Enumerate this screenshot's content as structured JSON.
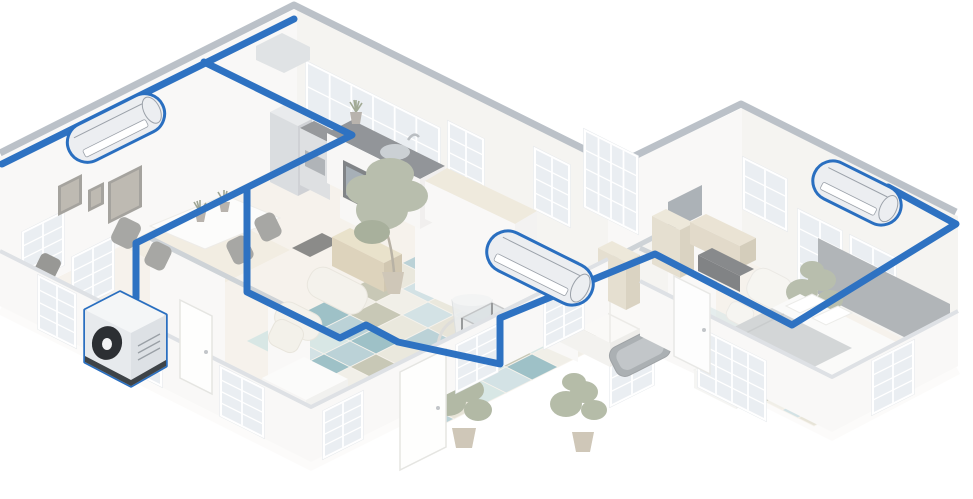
{
  "colors": {
    "background": "#ffffff",
    "pipe": "#2e72c2",
    "unitStroke": "#2a6fc0",
    "unitFill": "#eceef1",
    "unitDetail": "#9ba1a9",
    "wallTop": "#8e99a5",
    "partitionTop": "#aeb6be",
    "lowWallTop": "#c9ced4",
    "wallFace": "#f6f5f2",
    "wallFaceShade": "#efede9",
    "floor": "#f1ebe0",
    "floorFascia": "#fbfaf7",
    "diningInlay": "#e7dcc4",
    "windowFrame": "#ffffff",
    "windowPane": "#dde4eb",
    "frameOuter": "#6b675f",
    "frameInner": "#938d80",
    "outdoorDark": "#3e4347",
    "fanDark": "#2c2f33",
    "rugPalette": [
      "#8fb5be",
      "#b7cfd5",
      "#a4a487",
      "#d8d3bf",
      "#5f98a2",
      "#ddd9c7",
      "#bfd8d5",
      "#e9e6da"
    ]
  },
  "system": {
    "outdoor_unit": {
      "name": "outdoor-condenser-unit"
    },
    "indoor_units": [
      {
        "name": "indoor-wall-unit-left-room",
        "cx": 116,
        "cy": 128,
        "angle": -26.5,
        "length": 104,
        "height": 40
      },
      {
        "name": "indoor-wall-unit-center-room",
        "cx": 540,
        "cy": 268,
        "angle": 26.5,
        "length": 114,
        "height": 42
      },
      {
        "name": "indoor-wall-unit-right-bedroom",
        "cx": 857,
        "cy": 193,
        "angle": 26.5,
        "length": 94,
        "height": 40
      }
    ],
    "pipe_runs": [
      {
        "name": "pipe-back-wall-run",
        "points": [
          [
            2,
            164
          ],
          [
            294,
            19
          ]
        ]
      },
      {
        "name": "pipe-kitchen-branch",
        "points": [
          [
            204,
            62
          ],
          [
            352,
            135
          ],
          [
            136,
            243
          ],
          [
            136,
            298
          ]
        ]
      },
      {
        "name": "pipe-main-trunk",
        "points": [
          [
            247,
            190
          ],
          [
            247,
            292
          ],
          [
            340,
            338
          ],
          [
            366,
            325
          ],
          [
            398,
            342
          ],
          [
            500,
            364
          ],
          [
            500,
            318
          ],
          [
            655,
            254
          ],
          [
            792,
            325
          ],
          [
            956,
            224
          ],
          [
            888,
            187
          ]
        ]
      }
    ]
  },
  "windows": [
    {
      "x": 24,
      "y": 233,
      "w": 38,
      "h": 50,
      "skew": "v",
      "layer": "back",
      "cols": 2,
      "rows": 4
    },
    {
      "x": 74,
      "y": 258,
      "w": 38,
      "h": 50,
      "skew": "v",
      "layer": "back",
      "cols": 2,
      "rows": 4
    },
    {
      "x": 308,
      "y": 64,
      "w": 130,
      "h": 92,
      "skew": "u",
      "layer": "back",
      "cols": 6,
      "rows": 4
    },
    {
      "x": 450,
      "y": 124,
      "w": 32,
      "h": 58,
      "skew": "u",
      "layer": "back",
      "cols": 2,
      "rows": 4
    },
    {
      "x": 536,
      "y": 150,
      "w": 32,
      "h": 58,
      "skew": "u",
      "layer": "back",
      "cols": 2,
      "rows": 4
    },
    {
      "x": 586,
      "y": 132,
      "w": 50,
      "h": 74,
      "skew": "u",
      "layer": "back",
      "cols": 4,
      "rows": 4
    },
    {
      "x": 745,
      "y": 160,
      "w": 40,
      "h": 48,
      "skew": "u",
      "layer": "back",
      "cols": 2,
      "rows": 3
    },
    {
      "x": 800,
      "y": 212,
      "w": 40,
      "h": 68,
      "skew": "u",
      "layer": "back",
      "cols": 2,
      "rows": 4
    },
    {
      "x": 852,
      "y": 238,
      "w": 42,
      "h": 68,
      "skew": "u",
      "layer": "back",
      "cols": 2,
      "rows": 4
    },
    {
      "x": 612,
      "y": 352,
      "w": 40,
      "h": 52,
      "skew": "v",
      "layer": "back",
      "cols": 2,
      "rows": 4
    },
    {
      "x": 40,
      "y": 278,
      "w": 34,
      "h": 50,
      "skew": "u",
      "layer": "front",
      "cols": 2,
      "rows": 4
    },
    {
      "x": 120,
      "y": 318,
      "w": 40,
      "h": 46,
      "skew": "u",
      "layer": "front",
      "cols": 2,
      "rows": 4
    },
    {
      "x": 222,
      "y": 369,
      "w": 40,
      "h": 46,
      "skew": "u",
      "layer": "front",
      "cols": 2,
      "rows": 4
    },
    {
      "x": 325,
      "y": 412,
      "w": 36,
      "h": 44,
      "skew": "v",
      "layer": "front",
      "cols": 2,
      "rows": 4
    },
    {
      "x": 458,
      "y": 346,
      "w": 38,
      "h": 44,
      "skew": "v",
      "layer": "front",
      "cols": 2,
      "rows": 4
    },
    {
      "x": 546,
      "y": 302,
      "w": 36,
      "h": 44,
      "skew": "v",
      "layer": "front",
      "cols": 2,
      "rows": 4
    },
    {
      "x": 700,
      "y": 330,
      "w": 64,
      "h": 56,
      "skew": "u",
      "layer": "front",
      "cols": 4,
      "rows": 4
    },
    {
      "x": 874,
      "y": 362,
      "w": 38,
      "h": 50,
      "skew": "v",
      "layer": "front",
      "cols": 2,
      "rows": 4
    }
  ],
  "picture_frames": [
    {
      "x": 58,
      "y": 186,
      "w": 24,
      "h": 30,
      "skew": "v"
    },
    {
      "x": 88,
      "y": 190,
      "w": 16,
      "h": 22,
      "skew": "v"
    },
    {
      "x": 108,
      "y": 182,
      "w": 34,
      "h": 42,
      "skew": "v"
    }
  ],
  "rugs": [
    {
      "name": "living-room-patch-rug",
      "origin": [
        428,
        250
      ],
      "cell": 26,
      "cols": 7,
      "rows": 7
    },
    {
      "name": "bedroom-patch-rug",
      "origin": [
        798,
        370
      ],
      "cell": 16,
      "cols": 4,
      "rows": 3
    }
  ]
}
